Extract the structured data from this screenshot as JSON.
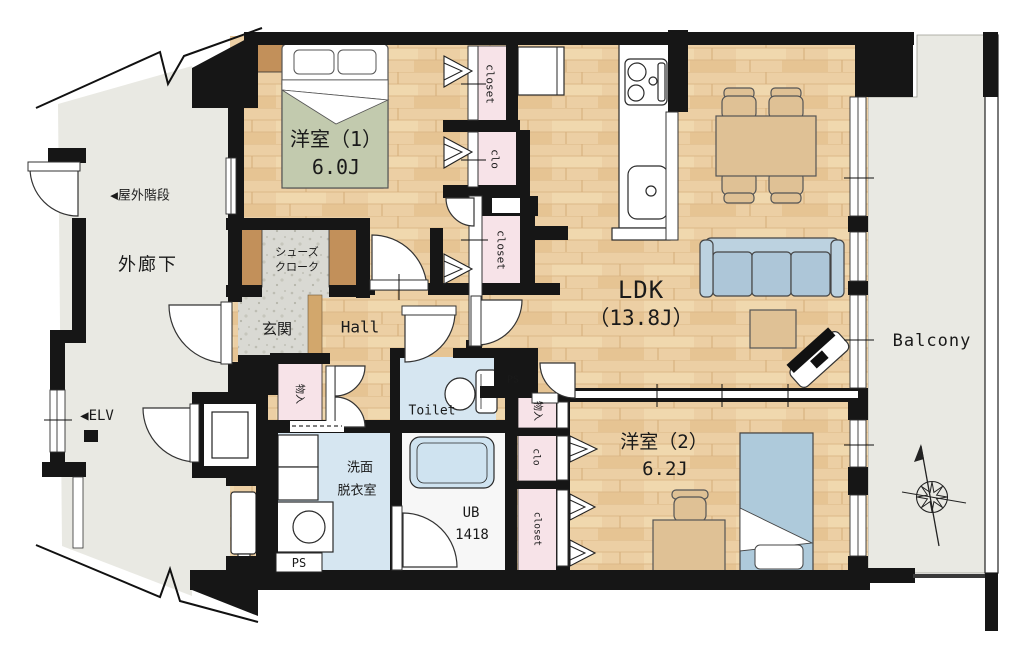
{
  "title": "apartment-floor-plan",
  "labels": {
    "room1": {
      "name": "洋室（1）",
      "size": "6.0J"
    },
    "room2": {
      "name": "洋室（2）",
      "size": "6.2J"
    },
    "ldk": {
      "name": "LDK",
      "size": "（13.8J）"
    },
    "balcony": "Balcony",
    "corridor": "外廊下",
    "outdoor_stairs": "◀屋外階段",
    "elevator": "◀ELV",
    "entrance": "玄関",
    "hall": "Hall",
    "shoes_closet": [
      "シューズ",
      "クローク"
    ],
    "toilet": "Toilet",
    "washroom": [
      "洗面",
      "脱衣室"
    ],
    "unit_bath": [
      "UB",
      "1418"
    ],
    "ps_upper": "PS",
    "ps_lower": "PS",
    "storage_hall": "物入",
    "storage_room2": "物入",
    "closet_room1_top": "closet",
    "clo_room1": "clo",
    "closet_hall": "closet",
    "clo_room2": "clo",
    "closet_room2": "closet"
  },
  "colors": {
    "wall": "#161616",
    "wood_floor": "#eccfa4",
    "wet_room_floor": "#d6e6f1",
    "closet_pink": "#f7e3e8",
    "outdoor_gray": "#e9e9e3",
    "stone_gray": "#d9d9d3",
    "furniture_blue": "#adc6d8",
    "furniture_tan": "#dfc195",
    "cabinet_brown": "#c2905a"
  }
}
